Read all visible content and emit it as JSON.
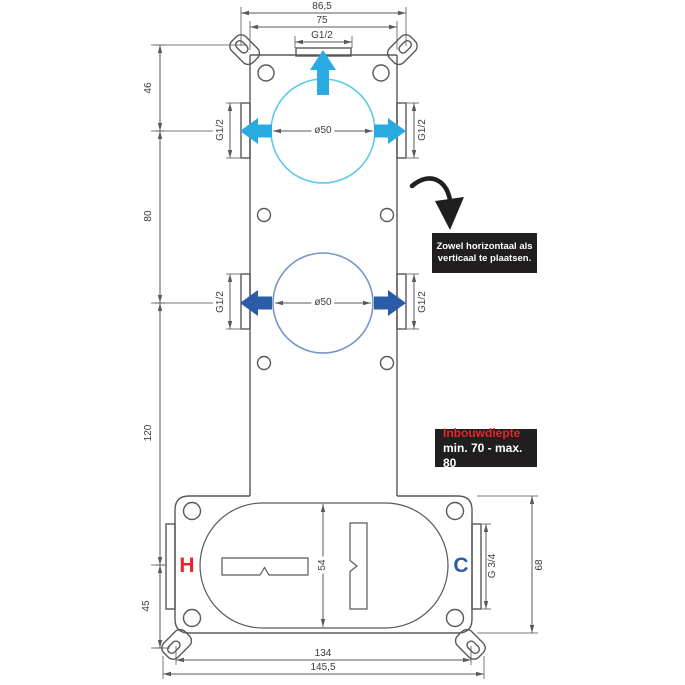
{
  "colors": {
    "cyan": "#29abe2",
    "blue": "#2b5ca8",
    "circle_cyan": "#58c9ef",
    "circle_blue": "#7496c9",
    "red": "#e8252a",
    "dark": "#211e1f",
    "line": "#58595b"
  },
  "diagram": {
    "top_dims": {
      "outer": "86,5",
      "body": "75",
      "port": "G1/2"
    },
    "left_dims": {
      "seg1": "46",
      "seg2": "80",
      "seg3": "120",
      "seg4": "45"
    },
    "upper_outlet": {
      "diameter": "ø50",
      "left_port": "G1/2",
      "right_port": "G1/2"
    },
    "lower_outlet": {
      "diameter": "ø50",
      "left_port": "G1/2",
      "right_port": "G1/2"
    },
    "body_box": {
      "inner_height": "54",
      "port_thread": "G 3/4",
      "height": "68",
      "width_inner": "134",
      "width_outer": "145,5",
      "hot": "H",
      "cold": "C"
    }
  },
  "callouts": {
    "placement": {
      "line1": "Zowel horizontaal als",
      "line2": "verticaal te plaatsen."
    },
    "depth": {
      "label": "Inbouwdiepte",
      "range": "min. 70 - max. 80"
    }
  }
}
